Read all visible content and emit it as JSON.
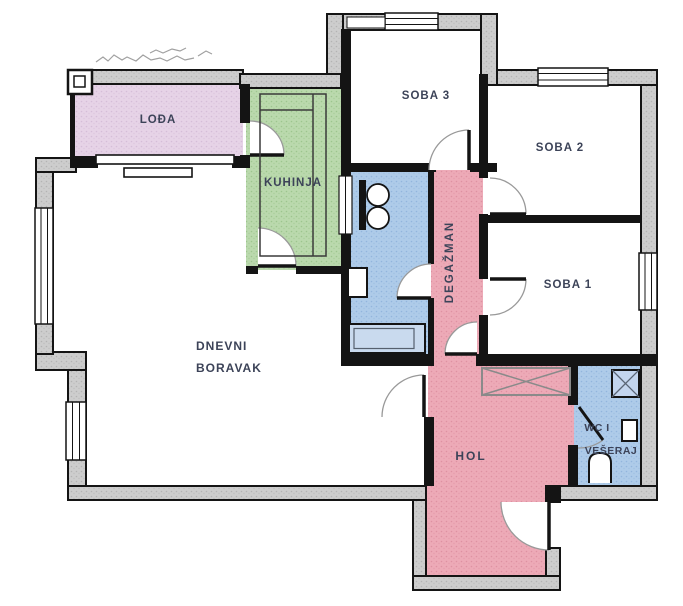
{
  "plan": {
    "rooms": {
      "loggia": {
        "label": "LOĐA"
      },
      "kitchen": {
        "label": "KUHINJA"
      },
      "bedroom3": {
        "label": "SOBA 3"
      },
      "bedroom2": {
        "label": "SOBA 2"
      },
      "bedroom1": {
        "label": "SOBA 1"
      },
      "degazman": {
        "label": "DEGAŽMAN"
      },
      "living_room": {
        "line1": "DNEVNI",
        "line2": "BORAVAK"
      },
      "hall": {
        "label": "HOL"
      },
      "wc_laundry": {
        "line1": "WC I",
        "line2": "VEŠERAJ"
      }
    },
    "fixtures": [
      "double-washbasin",
      "boiler",
      "bathtub",
      "kitchen-counter",
      "wardrobe",
      "washing-machine",
      "cistern",
      "toilet",
      "sliding-door",
      "pillar"
    ],
    "palette": {
      "wall": "#141414",
      "insulation_fill": "#cdcdcd",
      "loggia_fill": "#e6d3e7",
      "kitchen_fill": "#bad9ad",
      "bath_fill": "#aecbe9",
      "hall_fill": "#edaab7",
      "tub_fill": "#c9daee",
      "door_arc": "#999999",
      "label_default": "#3c4358",
      "label_loggia": "#4b3d5c",
      "label_kitchen": "#2e4d33",
      "label_degazman": "#5a3050",
      "label_hall": "#6e3245",
      "scribble": "#909090"
    }
  }
}
